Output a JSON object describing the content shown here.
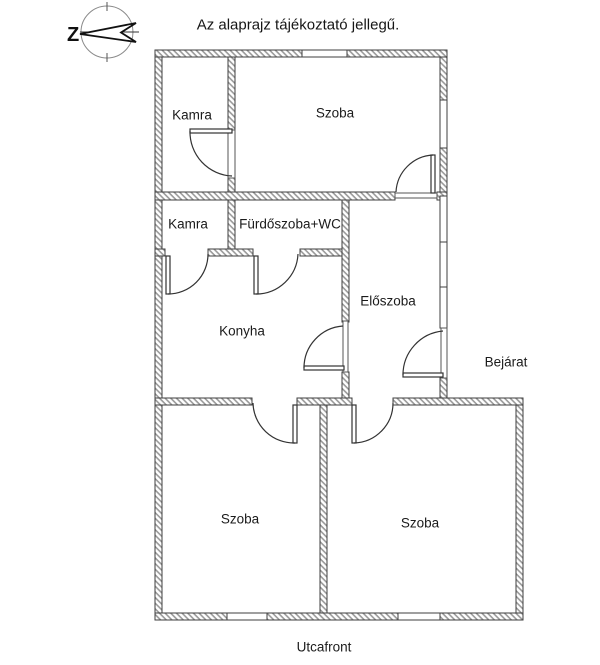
{
  "title": "Az alaprajz tájékoztató jellegű.",
  "compass": {
    "icon": "compass-rose-arrow-pointing-left",
    "north_label": "Z"
  },
  "rooms": {
    "kamra_top": "Kamra",
    "szoba_top": "Szoba",
    "kamra_mid": "Kamra",
    "furdoszoba": "Fürdőszoba+WC",
    "eloszoba": "Előszoba",
    "konyha": "Konyha",
    "szoba_bottom_left": "Szoba",
    "szoba_bottom_right": "Szoba"
  },
  "annotations": {
    "bejarat": "Bejárat",
    "utcafront": "Utcafront"
  },
  "colors": {
    "wall_outline": "#3f3f3f",
    "wall_hatch": "#9a9a9a",
    "door_line": "#333333",
    "text": "#1b1b1b",
    "background": "#ffffff"
  }
}
